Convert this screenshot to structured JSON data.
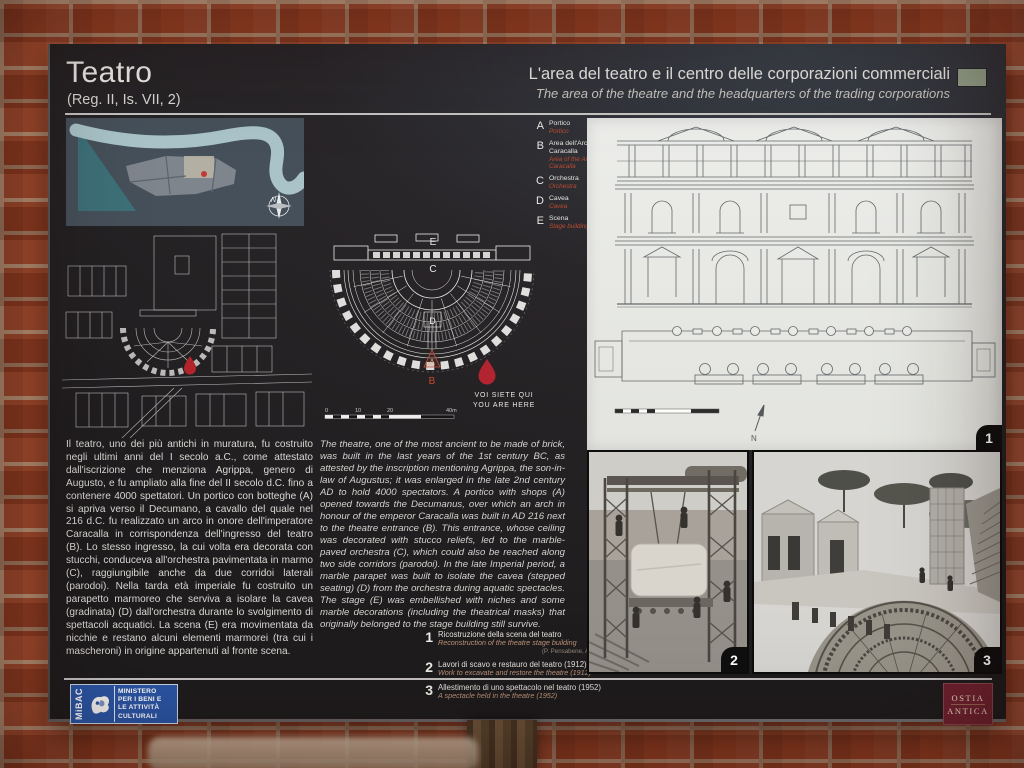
{
  "header": {
    "title": "Teatro",
    "subtitle": "(Reg. II, Is. VII, 2)",
    "right_title_it": "L'area del teatro e il centro delle corporazioni commerciali",
    "right_title_en": "The area of the theatre and the headquarters of the trading corporations"
  },
  "legend": {
    "items": [
      {
        "key": "A",
        "it": "Portico",
        "en": "Portico"
      },
      {
        "key": "B",
        "it": "Area dell'Arco di Caracalla",
        "en": "Area of the Arch of Caracalla"
      },
      {
        "key": "C",
        "it": "Orchestra",
        "en": "Orchestra"
      },
      {
        "key": "D",
        "it": "Cavea",
        "en": "Cavea"
      },
      {
        "key": "E",
        "it": "Scena",
        "en": "Stage building"
      }
    ]
  },
  "plan_labels": {
    "A": "A",
    "B": "B",
    "C": "C",
    "D": "D",
    "E": "E"
  },
  "you_are_here": {
    "it": "VOI SIETE QUI",
    "en": "YOU ARE HERE"
  },
  "scale_bar": {
    "ticks": [
      "0",
      "10",
      "20",
      "40m"
    ]
  },
  "compass": {
    "label": "N"
  },
  "body_it": "Il teatro, uno dei più antichi in muratura, fu costruito negli ultimi anni del I secolo a.C., come attestato dall'iscrizione che menziona Agrippa, genero di Augusto, e fu ampliato alla fine del II secolo d.C. fino a contenere 4000 spettatori. Un portico con botteghe (A) si apriva verso il Decumano, a cavallo del quale nel 216 d.C. fu realizzato un arco in onore dell'imperatore Caracalla in corrispondenza dell'ingresso del teatro (B). Lo stesso ingresso, la cui volta era decorata con stucchi, conduceva all'orchestra pavimentata in marmo (C), raggiungibile anche da due corridoi laterali (parodoi). Nella tarda età imperiale fu costruito un parapetto marmoreo che serviva a isolare la cavea (gradinata) (D) dall'orchestra durante lo svolgimento di spettacoli acquatici. La scena (E) era movimentata da nicchie e restano alcuni elementi marmorei (tra cui i mascheroni) in origine appartenuti al fronte scena.",
  "body_en": "The theatre, one of the most ancient to be made of brick, was built in the last years of the 1st century BC, as attested by the inscription mentioning Agrippa, the son-in-law of Augustus; it was enlarged in the late 2nd century AD to hold 4000 spectators. A portico with shops (A) opened towards the Decumanus, over which an arch in honour of the emperor Caracalla was built in AD 216 next to the theatre entrance (B). This entrance, whose ceiling was decorated with stucco reliefs, led to the marble-paved orchestra (C), which could also be reached along two side corridors (parodoi). In the late Imperial period, a marble parapet was built to isolate the cavea (stepped seating) (D) from the orchestra during aquatic spectacles. The stage (E) was embellished with niches and some marble decorations (including the theatrical masks) that originally belonged to the stage building still survive.",
  "captions": [
    {
      "num": "1",
      "it": "Ricostruzione della scena del teatro",
      "en": "Reconstruction of the theatre stage building",
      "credit": "(P. Pensabene, A. Pellucci)"
    },
    {
      "num": "2",
      "it": "Lavori di scavo e restauro del teatro (1912)",
      "en": "Work to excavate and restore the theatre (1912)"
    },
    {
      "num": "3",
      "it": "Allestimento di uno spettacolo nel teatro (1952)",
      "en": "A spectacle held in the theatre (1952)"
    }
  ],
  "figure_badges": [
    "1",
    "2",
    "3"
  ],
  "logos": {
    "mibac": {
      "acronym": "MiBAC",
      "lines": [
        "MINISTERO",
        "PER I BENI E",
        "LE ATTIVITÀ",
        "CULTURALI"
      ]
    },
    "ostia": {
      "line1": "OSTIA",
      "line2": "ANTICA"
    }
  },
  "colors": {
    "panel_bg": "#232021",
    "accent_red": "#c0392e",
    "legend_en": "#bc4c31",
    "chip_green": "#94a18a",
    "mibac_blue": "#2a55a4",
    "ostia_maroon": "#6e2230",
    "brick": "#a8492a",
    "mortar": "#c49a7c",
    "drawing_bg": "#e9e9e4"
  }
}
